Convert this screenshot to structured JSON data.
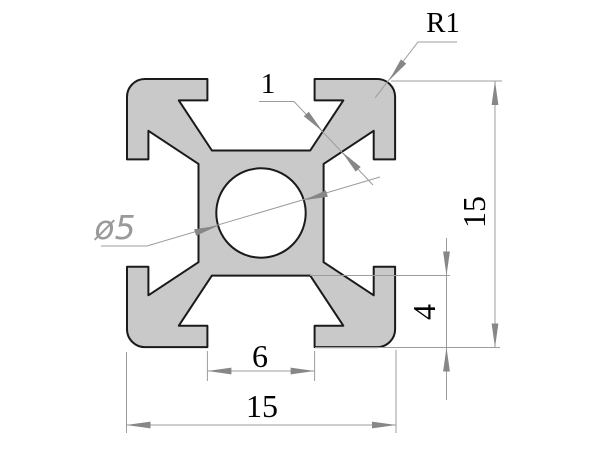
{
  "colors": {
    "background": "#ffffff",
    "profile_fill": "#c9c9c9",
    "profile_stroke": "#1a1a1a",
    "dim_line": "#9c9c9c",
    "arrow_fill": "#878787",
    "dim_text": "#000000",
    "dia_text": "#9a9a9a"
  },
  "dims": {
    "corner_radius": {
      "label": "R1",
      "value": 1
    },
    "wall_thickness": {
      "label": "1",
      "value": 1
    },
    "bore_diameter": {
      "label": "ø5",
      "value": 5
    },
    "overall_height": {
      "label": "15",
      "value": 15
    },
    "slot_depth": {
      "label": "4",
      "value": 4
    },
    "slot_opening": {
      "label": "6",
      "value": 6
    },
    "overall_width": {
      "label": "15",
      "value": 15
    }
  }
}
